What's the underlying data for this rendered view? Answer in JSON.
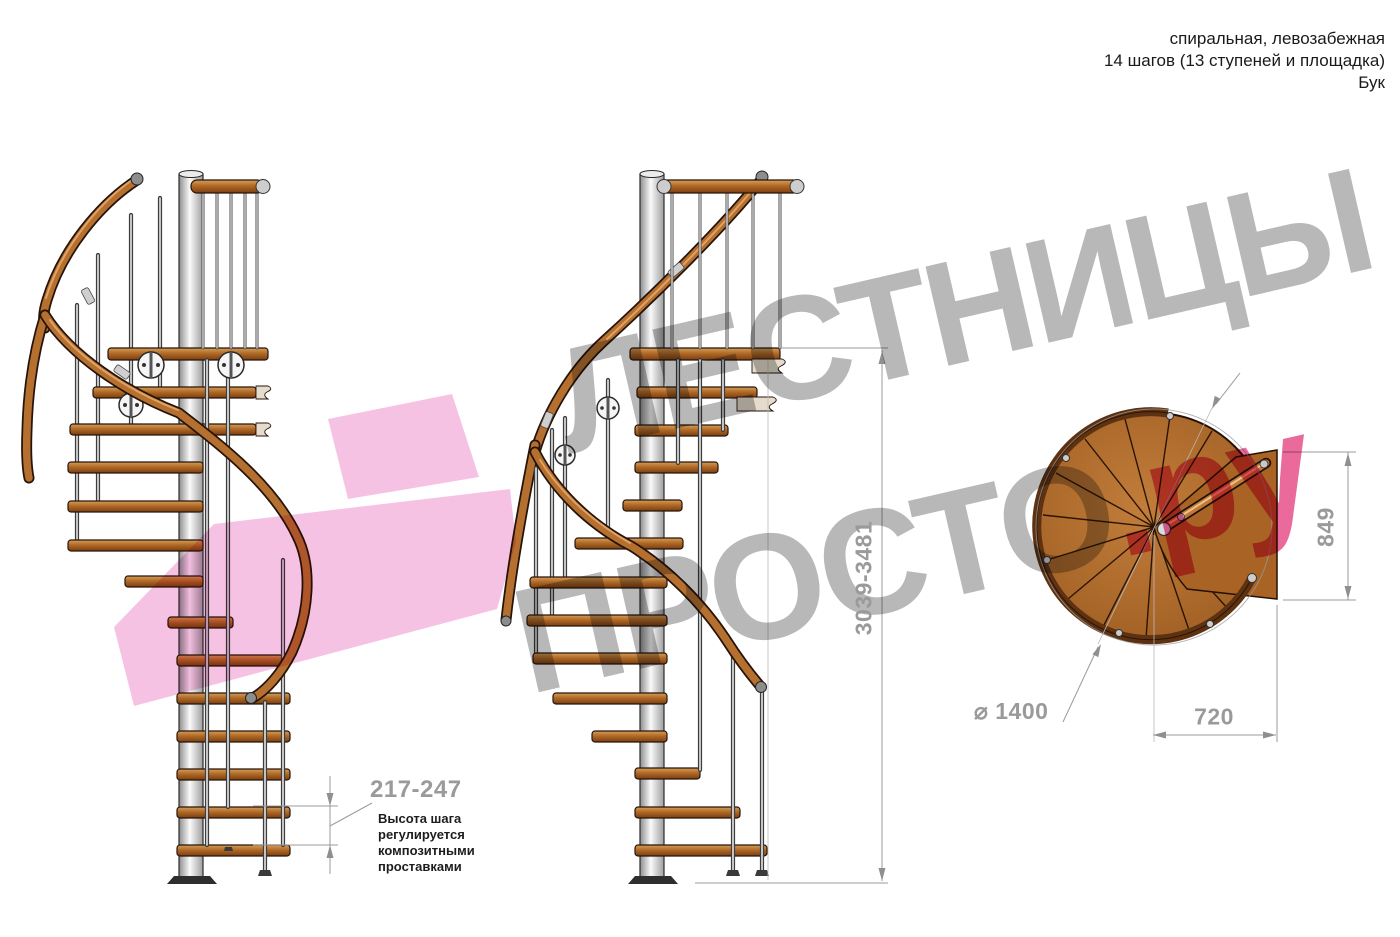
{
  "header": {
    "lines": [
      "спиральная, левозабежная",
      "14 шагов (13 ступеней и площадка)",
      "Бук"
    ]
  },
  "watermark": {
    "word_top": "ЛЕСТНИЦЫ",
    "word_bottom": "ПРОСТО",
    "word_bottom_accent": ".ру"
  },
  "annotations": {
    "step_height": {
      "value": "217-247",
      "note": "Высота шага регулируется композитными проставками"
    },
    "total_height": {
      "value": "3039-3481"
    },
    "plan_side": {
      "value": "849"
    },
    "plan_width": {
      "value": "720"
    },
    "plan_diameter": {
      "symbol": "⌀",
      "value": "1400"
    }
  },
  "colors": {
    "watermark_gray": "#b2b2b2",
    "brand_pink": "#e75d92",
    "logo_pink": "#ee86c8",
    "wood": "#b06a28",
    "wood_dark": "#5e3110",
    "metal": "#d9d9d9",
    "dimension_gray": "#9a9a9a",
    "text_dark": "#1a1a1a"
  }
}
